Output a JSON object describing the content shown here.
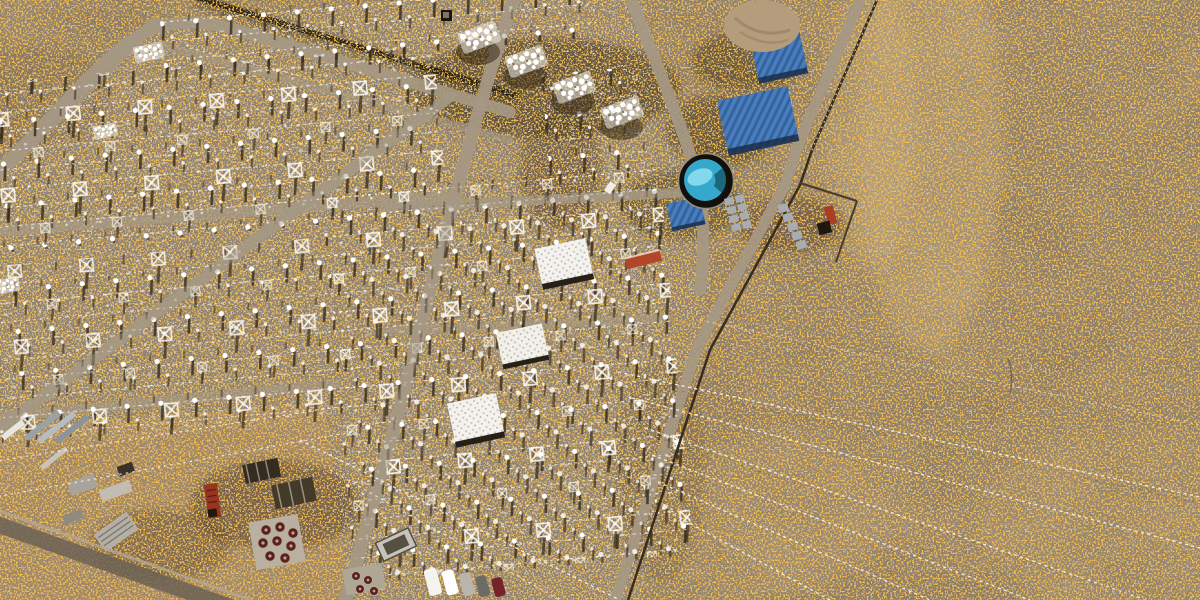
{
  "scene": {
    "type": "aerial-satellite-photo",
    "subject": "High-voltage electrical substation and switchyard in open desert terrain",
    "appearance": "false-color imagery with dense orange speckle over gray-brown ground"
  },
  "palette": {
    "desertBase": "#8a7c6c",
    "speckleOrange": "#ef8812",
    "yardGravel": "#8e8275",
    "laydownSand": "#a18a6d",
    "roadLight": "#a59884",
    "equipmentWhite": "#ffffff",
    "shadowBrown": "#3a2d1b",
    "roofBlue": "#4a7dbd",
    "roofBlueDark": "#2f5d96",
    "water": "#36a8cc",
    "waterBright": "#8adeee",
    "tankRing": "#12100c",
    "mound": "#b59c7c",
    "containerGray": "#a7adb2",
    "containerRed": "#aa3d26",
    "redStructure": "#b2452a",
    "truckRed": "#97351f",
    "reelRed": "#58211c",
    "lineWhite": "#fdfaf4",
    "darkRoad": "#6b6155"
  },
  "vehicles": {
    "count": 5,
    "colors": [
      "#f5f3ee",
      "#ffffff",
      "#b9b5ae",
      "#6e6a64",
      "#76222c",
      "#e9e6df"
    ]
  },
  "features": {
    "switchyard": "gridded switchyard bays with insulator rows and lattice towers",
    "transformer_bank": {
      "count": 4,
      "look": "bright white radiator clusters on dark pads"
    },
    "control_buildings": {
      "count": 3,
      "roof": "white speckled"
    },
    "warehouses": {
      "count": 3,
      "roof": "blue corrugated"
    },
    "water_tank": {
      "shape": "circular",
      "content": "cyan water"
    },
    "dirt_mound": "tan spoil pile near north warehouses",
    "container_storage": "gray and red containers along east compound wall",
    "laydown_yard": "southwest storage yard with material stacks, sheds, cable reels, red truck, parked cars",
    "transmission_lines": {
      "count": 9,
      "direction": "fanning to the southeast"
    },
    "perimeter": "walled compound with light service roads"
  }
}
